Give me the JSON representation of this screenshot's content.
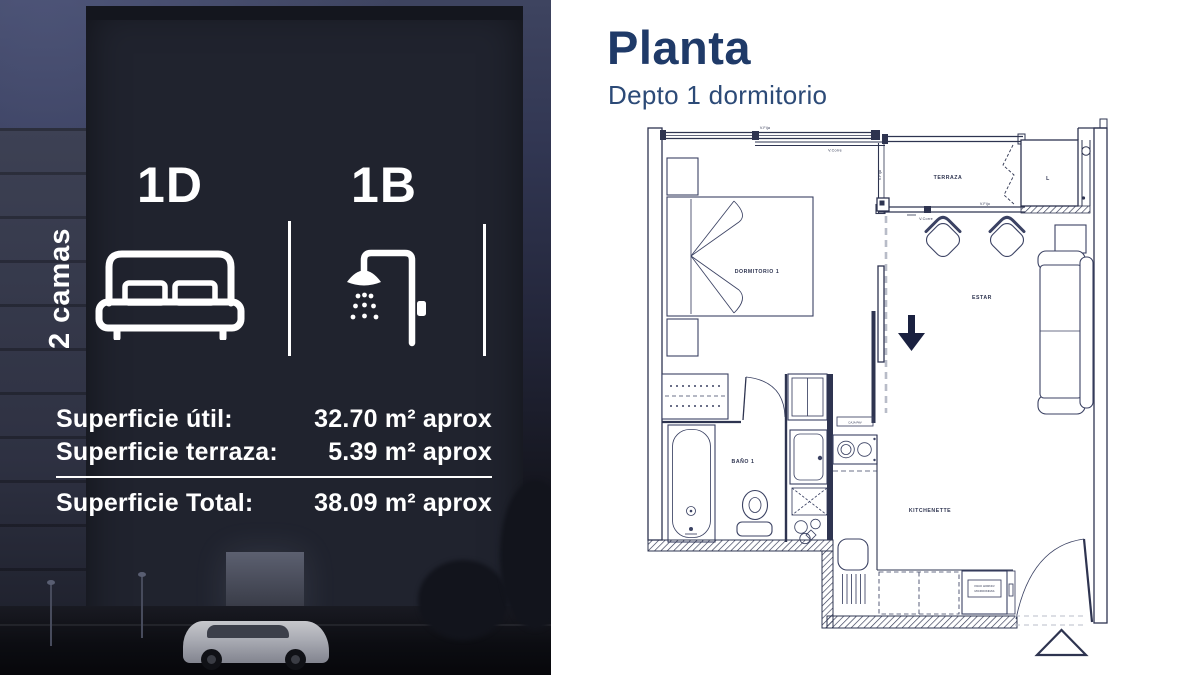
{
  "left_panel": {
    "vertical_label": "2 camas",
    "unit": {
      "bedrooms_code": "1D",
      "bathrooms_code": "1B"
    },
    "areas": {
      "rows": [
        {
          "label": "Superficie útil:",
          "value": "32.70 m² aprox"
        },
        {
          "label": "Superficie terraza:",
          "value": "5.39 m² aprox"
        }
      ],
      "total": {
        "label": "Superficie Total:",
        "value": "38.09 m² aprox"
      }
    }
  },
  "right_panel": {
    "title": "Planta",
    "subtitle": "Depto 1 dormitorio",
    "floor_plan": {
      "labels": {
        "dormitorio": "DORMITORIO 1",
        "terraza": "TERRAZA",
        "logia": "L",
        "estar": "ESTAR",
        "bano": "BAÑO 1",
        "kitchenette": "KITCHENETTE",
        "v_fija": "V.Fija",
        "v_corre": "V.Corre",
        "v_fijo": "V.Fijo",
        "caja": "CAJA PAV",
        "pack_line1": "PACK HORNO/",
        "pack_line2": "MICROONDAS"
      }
    }
  },
  "colors": {
    "title_navy": "#1f3a68",
    "plan_ink": "#2e3450",
    "overlay_white": "#ffffff",
    "night_sky": "#3e4460"
  },
  "icons": {
    "bed": "double-bed-icon",
    "shower": "shower-icon",
    "entry_arrow": "down-arrow-icon",
    "access_marker": "triangle-access-icon"
  }
}
